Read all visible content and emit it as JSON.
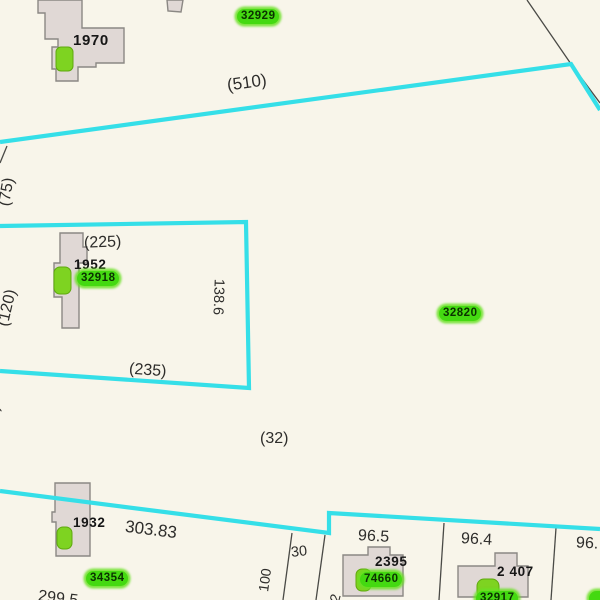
{
  "map": {
    "type": "parcel-assessor-map",
    "colors": {
      "background": "#f8f5ea",
      "parcel_boundary": "#35dfe8",
      "lot_line": "#4a4a46",
      "building_fill": "#e0d8d5",
      "building_outline": "#8b8884",
      "parcel_id_pill": "#44d911",
      "tree_marker": "#7ed321",
      "label_text": "#2e2d2b"
    }
  },
  "parcel_ids": {
    "id_32929": "32929",
    "id_32918": "32918",
    "id_32820": "32820",
    "id_34354": "34354",
    "id_74660": "74660",
    "id_32917": "32917",
    "id_partial_right": ""
  },
  "building_numbers": {
    "b1970": "1970",
    "b1952": "1952",
    "b1932": "1932",
    "b2395": "2395",
    "b2407": "2 407"
  },
  "dimensions": {
    "d510": "(510)",
    "d75": "(75)",
    "d225": "(225)",
    "d120": "(120)",
    "d138_6": "138.6",
    "d235": "(235)",
    "d32": "(32)",
    "d80_partial": "(80)",
    "d303_83": "303.83",
    "d299_5": "299.5",
    "d100": "100",
    "d30": "30",
    "d2_partial": "2",
    "d96_5": "96.5",
    "d96_4": "96.4",
    "d96_right": "96."
  }
}
